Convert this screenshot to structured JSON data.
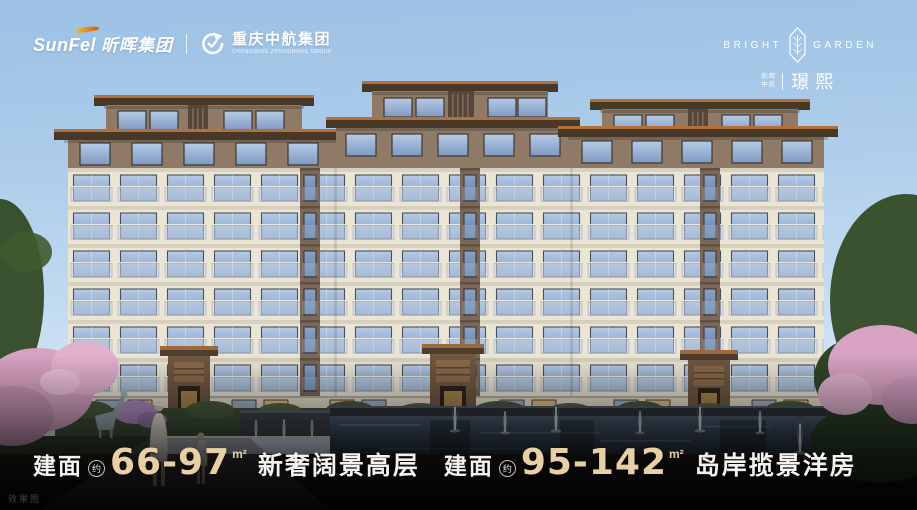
{
  "header": {
    "sunfel_latin": "SunFel",
    "sunfel_cn": "昕晖集团",
    "divider": "|",
    "zhonghang_cn": "重庆中航集团",
    "zhonghang_en": "CHONGQING ZHONGHANG GROUP"
  },
  "brand": {
    "word_left": "BRIGHT",
    "word_right": "GARDEN",
    "sub_line1": "昕晖",
    "sub_line2": "中航",
    "name": "璟熙"
  },
  "slogans": [
    {
      "prefix": "建面",
      "approx": "约",
      "range": "66-97",
      "unit": "m²",
      "text": "新奢阔景高层"
    },
    {
      "prefix": "建面",
      "approx": "约",
      "range": "95-142",
      "unit": "m²",
      "text": "岛岸揽景洋房"
    }
  ],
  "watermark": "效果图",
  "colors": {
    "accent_gold": "#e9cfa4",
    "sky_top": "#9cc1e5",
    "sky_bottom": "#e6f1f9",
    "facade_cream": "#ebe5d5",
    "penthouse_brown": "#8f7a67",
    "roof_copper": "#b3703a",
    "roof_dark": "#483828",
    "window_blue": "#8fa8cc",
    "blossom_pink": "#d8a2c2",
    "foliage_green": "#3a5230",
    "water_dark": "#2c3a46",
    "text_white": "#f3f2ef"
  }
}
